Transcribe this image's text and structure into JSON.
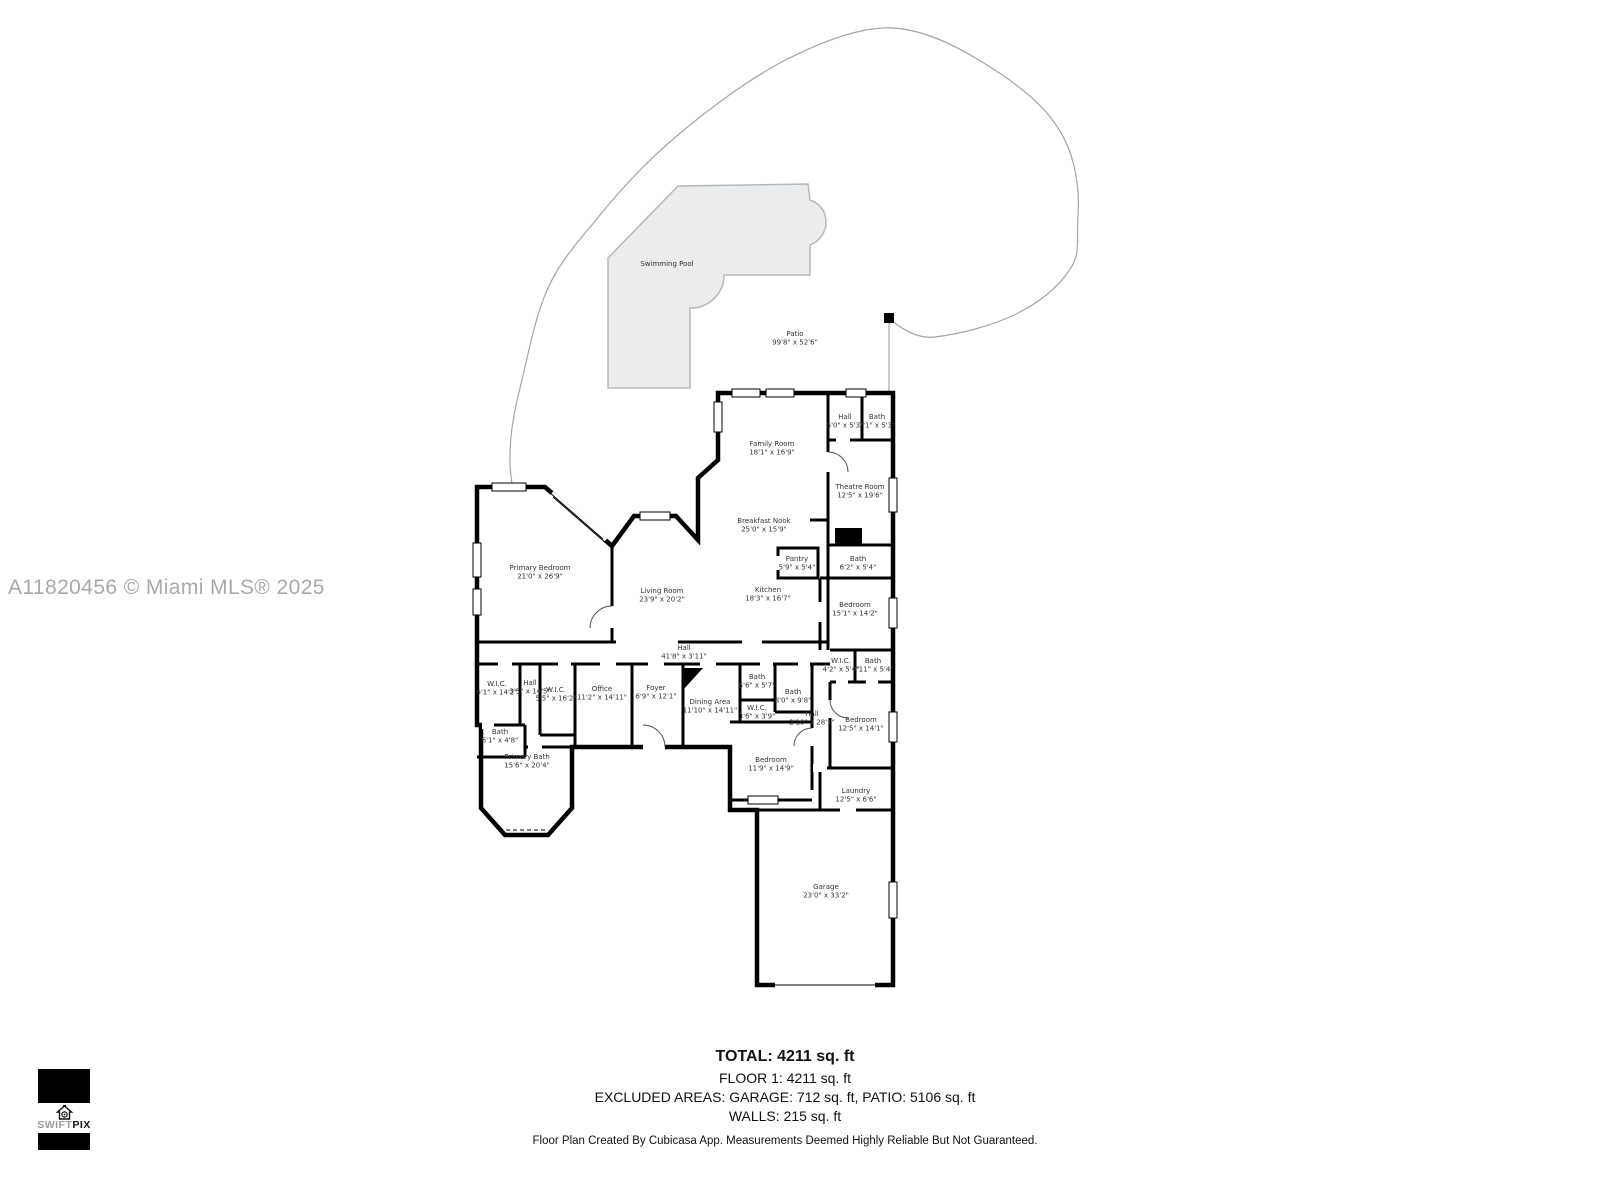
{
  "watermark": "A11820456 © Miami MLS® 2025",
  "logo": {
    "brand_light": "SWIFT",
    "brand_bold": "PIX"
  },
  "summary": {
    "total": "TOTAL: 4211 sq. ft",
    "floor1": "FLOOR 1: 4211 sq. ft",
    "excluded": "EXCLUDED AREAS: GARAGE: 712 sq. ft, PATIO: 5106 sq. ft",
    "walls": "WALLS: 215 sq. ft",
    "disclaimer": "Floor Plan Created By Cubicasa App. Measurements Deemed Highly Reliable But Not Guaranteed."
  },
  "floorplan": {
    "outdoor": [
      {
        "name": "Swimming Pool",
        "dims": "",
        "x": 667,
        "y": 266
      },
      {
        "name": "Patio",
        "dims": "99'8\" x 52'6\"",
        "x": 795,
        "y": 336
      }
    ],
    "rooms": [
      {
        "name": "Family Room",
        "dims": "18'1\" x 16'9\"",
        "x": 772,
        "y": 446
      },
      {
        "name": "Hall",
        "dims": "5'0\" x 5'3\"",
        "x": 845,
        "y": 419
      },
      {
        "name": "Bath",
        "dims": "7'1\" x 5'3\"",
        "x": 877,
        "y": 419
      },
      {
        "name": "Theatre Room",
        "dims": "12'5\" x 19'6\"",
        "x": 860,
        "y": 489
      },
      {
        "name": "Breakfast Nook",
        "dims": "25'0\" x 15'9\"",
        "x": 764,
        "y": 523
      },
      {
        "name": "Pantry",
        "dims": "5'9\" x 5'4\"",
        "x": 797,
        "y": 561
      },
      {
        "name": "Bath",
        "dims": "6'2\" x 5'4\"",
        "x": 858,
        "y": 561
      },
      {
        "name": "Primary Bedroom",
        "dims": "21'0\" x 26'9\"",
        "x": 540,
        "y": 570
      },
      {
        "name": "Living Room",
        "dims": "23'9\" x 20'2\"",
        "x": 662,
        "y": 593
      },
      {
        "name": "Kitchen",
        "dims": "18'3\" x 16'7\"",
        "x": 768,
        "y": 592
      },
      {
        "name": "Bedroom",
        "dims": "15'1\" x 14'2\"",
        "x": 855,
        "y": 607
      },
      {
        "name": "Hall",
        "dims": "41'8\" x 3'11\"",
        "x": 684,
        "y": 650
      },
      {
        "name": "W.I.C.",
        "dims": "6'1\" x 14'2\"",
        "x": 497,
        "y": 686
      },
      {
        "name": "Hall",
        "dims": "3'5\" x 14'5\"",
        "x": 530,
        "y": 685
      },
      {
        "name": "W.I.C.",
        "dims": "5'5\" x 16'2\"",
        "x": 556,
        "y": 692
      },
      {
        "name": "Office",
        "dims": "11'2\" x 14'11\"",
        "x": 602,
        "y": 691
      },
      {
        "name": "Foyer",
        "dims": "6'9\" x 12'1\"",
        "x": 656,
        "y": 690
      },
      {
        "name": "Dining Area",
        "dims": "11'10\" x 14'11\"",
        "x": 710,
        "y": 704
      },
      {
        "name": "Bath",
        "dims": "5'6\" x 5'7\"",
        "x": 757,
        "y": 679
      },
      {
        "name": "Bath",
        "dims": "8'0\" x 9'8\"",
        "x": 793,
        "y": 694
      },
      {
        "name": "W.I.C.",
        "dims": "3'6\" x 3'9\"",
        "x": 757,
        "y": 710
      },
      {
        "name": "Hall",
        "dims": "2'10\" x 28'1\"",
        "x": 812,
        "y": 716
      },
      {
        "name": "W.I.C.",
        "dims": "4'2\" x 5'4\"",
        "x": 841,
        "y": 663
      },
      {
        "name": "Bath",
        "dims": "7'11\" x 5'4\"",
        "x": 873,
        "y": 663
      },
      {
        "name": "Bedroom",
        "dims": "12'5\" x 14'1\"",
        "x": 861,
        "y": 722
      },
      {
        "name": "Bedroom",
        "dims": "11'9\" x 14'9\"",
        "x": 771,
        "y": 762
      },
      {
        "name": "Bath",
        "dims": "6'1\" x 4'8\"",
        "x": 500,
        "y": 734
      },
      {
        "name": "Primary Bath",
        "dims": "15'6\" x 20'4\"",
        "x": 527,
        "y": 759
      },
      {
        "name": "Laundry",
        "dims": "12'5\" x 6'6\"",
        "x": 856,
        "y": 793
      },
      {
        "name": "Garage",
        "dims": "23'0\" x 33'2\"",
        "x": 826,
        "y": 889
      }
    ]
  },
  "colors": {
    "wall": "#000000",
    "pool_fill": "#eaecee",
    "pool_stroke": "#b5b8ba",
    "boundary": "#a5a5a5",
    "watermark": "#a9a9a9"
  }
}
